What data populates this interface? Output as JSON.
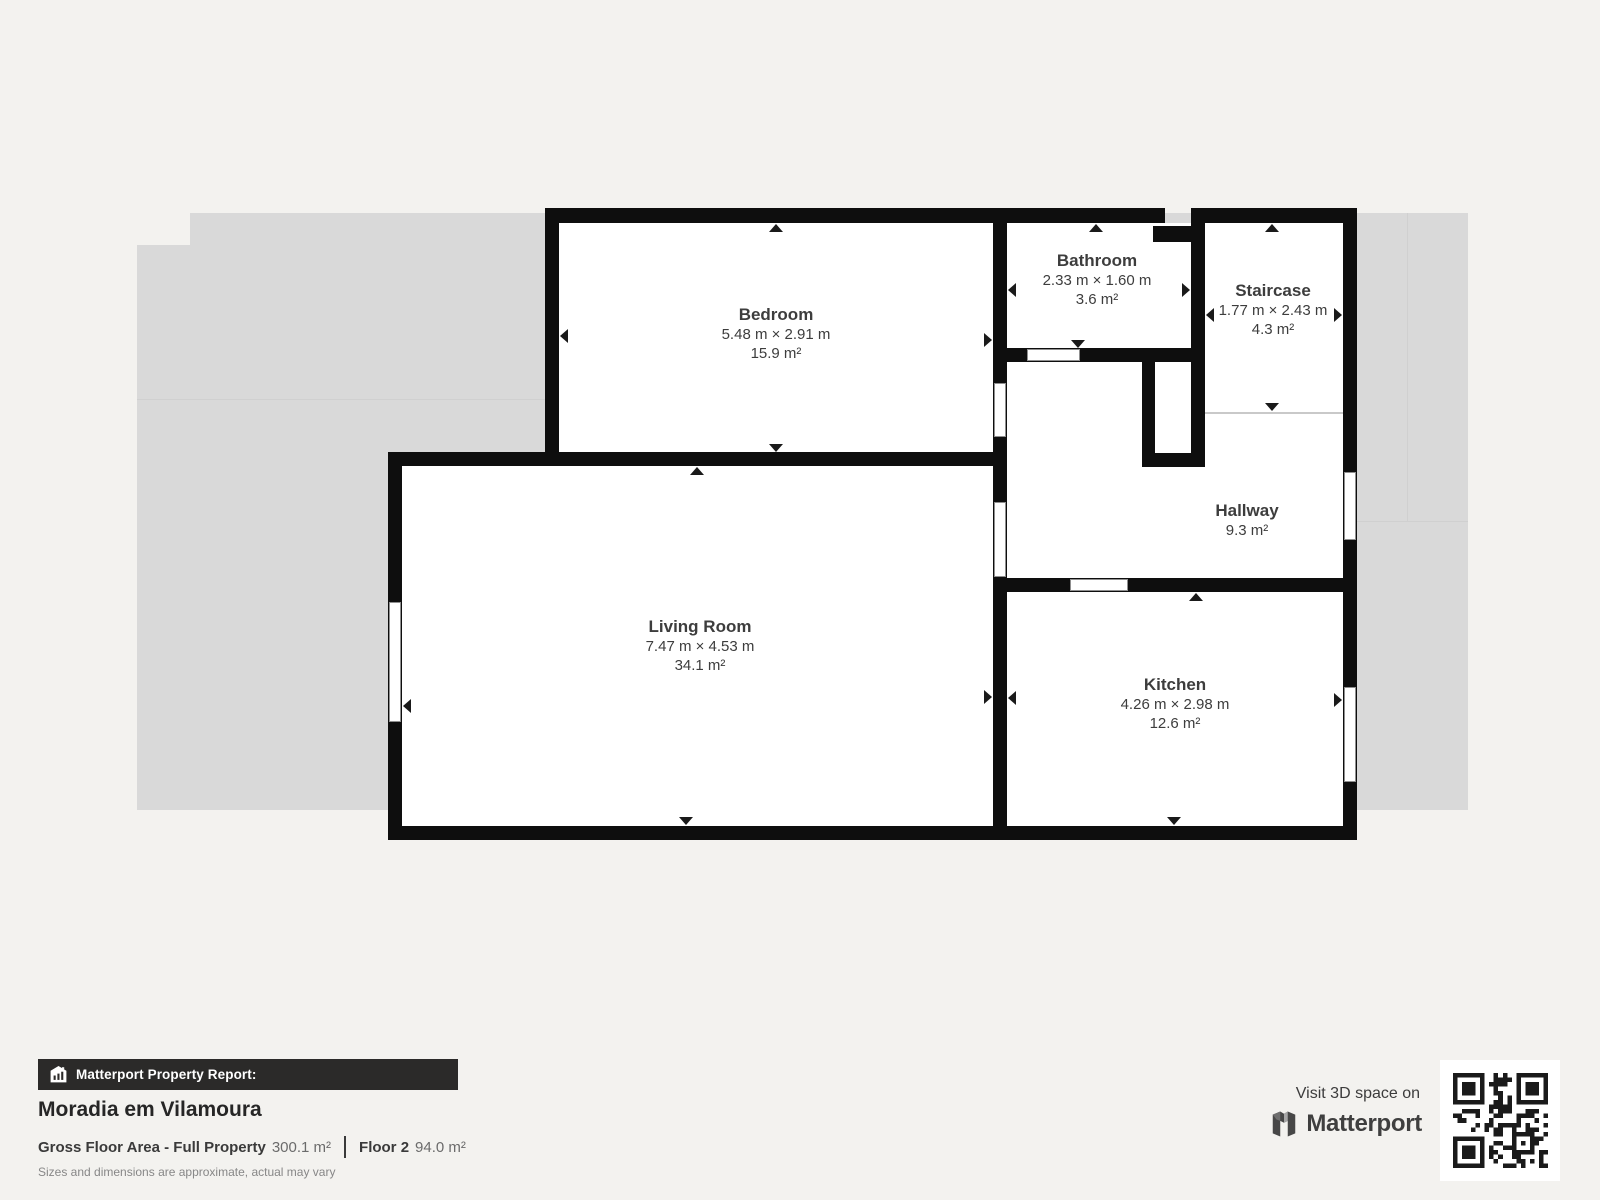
{
  "plan": {
    "rooms": [
      {
        "name": "Bedroom",
        "dims": "5.48 m × 2.91 m",
        "area": "15.9 m²"
      },
      {
        "name": "Bathroom",
        "dims": "2.33 m × 1.60 m",
        "area": "3.6 m²"
      },
      {
        "name": "Staircase",
        "dims": "1.77 m × 2.43 m",
        "area": "4.3 m²"
      },
      {
        "name": "Hallway",
        "dims": "",
        "area": "9.3 m²"
      },
      {
        "name": "Living Room",
        "dims": "7.47 m × 4.53 m",
        "area": "34.1 m²"
      },
      {
        "name": "Kitchen",
        "dims": "4.26 m × 2.98 m",
        "area": "12.6 m²"
      }
    ]
  },
  "footer": {
    "report_label": "Matterport Property Report:",
    "property_title": "Moradia em Vilamoura",
    "gross_label": "Gross Floor Area - Full Property",
    "gross_value": "300.1 m²",
    "floor_label": "Floor 2",
    "floor_value": "94.0 m²",
    "disclaimer": "Sizes and dimensions are approximate, actual may vary"
  },
  "branding": {
    "visit_text": "Visit 3D space on",
    "brand_name": "Matterport"
  },
  "colors": {
    "background": "#f3f2ef",
    "underlay": "#d9d9d9",
    "wall": "#0e0e0e",
    "room_fill": "#ffffff",
    "label_text": "#3d3d3d",
    "report_bar": "#2b2a29"
  }
}
